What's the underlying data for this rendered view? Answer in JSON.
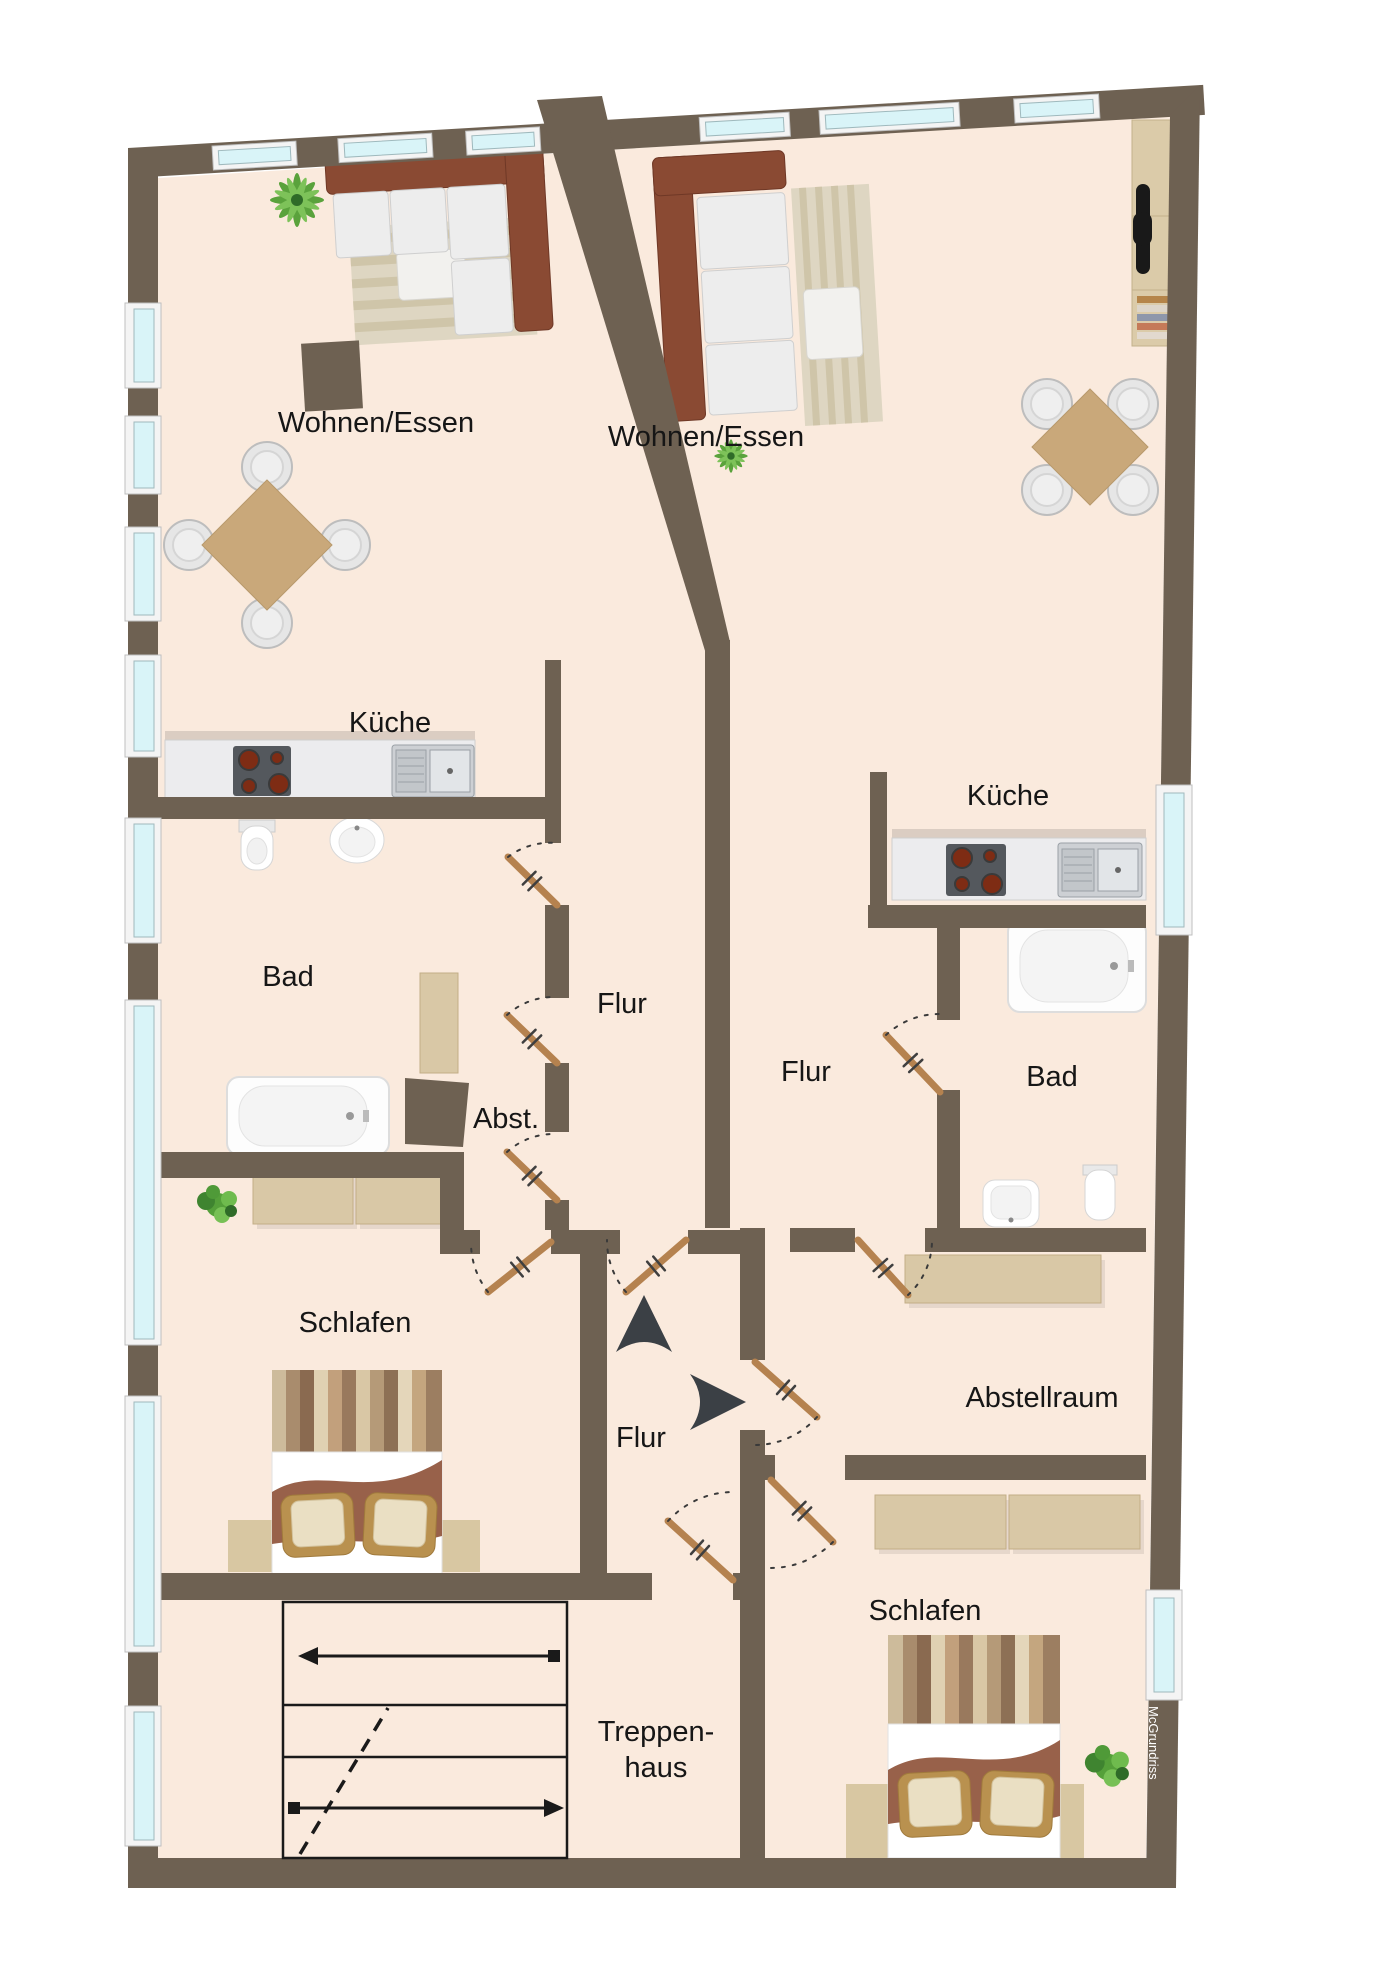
{
  "floor_plan": {
    "watermark": "McGrundriss",
    "labels": {
      "living_left": "Wohnen/Essen",
      "living_right": "Wohnen/Essen",
      "kitchen_left": "Küche",
      "kitchen_right": "Küche",
      "bath_left": "Bad",
      "bath_right": "Bad",
      "hall_left": "Flur",
      "hall_right": "Flur",
      "hall_landing": "Flur",
      "storage_abbr": "Abst.",
      "storage_room": "Abstellraum",
      "bedroom_left": "Schlafen",
      "bedroom_right": "Schlafen",
      "staircase_line1": "Treppen-",
      "staircase_line2": "haus"
    },
    "colors": {
      "wall": "#6e6152",
      "floor": "#faeadd",
      "window_glass": "#d9f4f8",
      "door": "#b5824f",
      "stair_lines": "#1a1a1a",
      "arrow": "#3b4045"
    }
  }
}
